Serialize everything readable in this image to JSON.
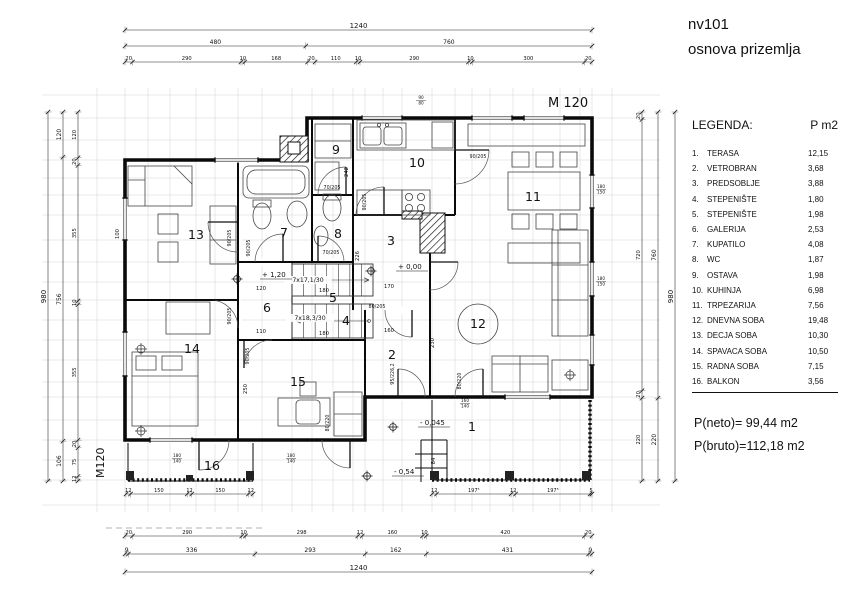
{
  "title": {
    "line1": "nv101",
    "line2": "osnova prizemlja"
  },
  "scale": {
    "main": "M 120",
    "side": "M120"
  },
  "legend": {
    "title": "LEGENDA:",
    "area_header": "P m2",
    "items": [
      {
        "num": "1.",
        "name": "TERASA",
        "area": "12,15"
      },
      {
        "num": "2.",
        "name": "VETROBRAN",
        "area": "3,68"
      },
      {
        "num": "3.",
        "name": "PREDSOBLJE",
        "area": "3,88"
      },
      {
        "num": "4.",
        "name": "STEPENIŠTE",
        "area": "1,80"
      },
      {
        "num": "5.",
        "name": "STEPENIŠTE",
        "area": "1,98"
      },
      {
        "num": "6.",
        "name": "GALERIJA",
        "area": "2,53"
      },
      {
        "num": "7.",
        "name": "KUPATILO",
        "area": "4,08"
      },
      {
        "num": "8.",
        "name": "WC",
        "area": "1,87"
      },
      {
        "num": "9.",
        "name": "OSTAVA",
        "area": "1,98"
      },
      {
        "num": "10.",
        "name": "KUHINJA",
        "area": "6,98"
      },
      {
        "num": "11.",
        "name": "TRPEZARIJA",
        "area": "7,56"
      },
      {
        "num": "12.",
        "name": "DNEVNA SOBA",
        "area": "19,48"
      },
      {
        "num": "13.",
        "name": "DECJA SOBA",
        "area": "10,30"
      },
      {
        "num": "14.",
        "name": "SPAVACA SOBA",
        "area": "10,50"
      },
      {
        "num": "15.",
        "name": "RADNA SOBA",
        "area": "7,15"
      },
      {
        "num": "16.",
        "name": "BALKON",
        "area": "3,56"
      }
    ],
    "neto": "P(neto)= 99,44 m2",
    "bruto": "P(bruto)=112,18 m2"
  },
  "plan": {
    "room_numbers": [
      "1",
      "2",
      "3",
      "4",
      "5",
      "6",
      "7",
      "8",
      "9",
      "10",
      "11",
      "12",
      "13",
      "14",
      "15",
      "16"
    ],
    "stair_labels": [
      "7x17,1/30",
      "7x18,3/30"
    ],
    "level_labels": [
      "+ 1,20",
      "+ 0,00",
      "- 0,045",
      "- 0,54"
    ],
    "door_labels": [
      "90/205",
      "90/205",
      "90/205",
      "90/205",
      "70/205",
      "70/205",
      "90/205",
      "90/205",
      "80/205",
      "95/226,2",
      "80/220",
      "80/220"
    ],
    "inner_dims": [
      "242",
      "226",
      "170",
      "120",
      "110",
      "180",
      "180",
      "160",
      "230",
      "250",
      "100",
      "84"
    ],
    "window_marks": [
      {
        "w": "90",
        "p": "80"
      },
      {
        "w": "180",
        "p": "150"
      },
      {
        "w": "180",
        "p": "150"
      },
      {
        "w": "180",
        "p": "140"
      },
      {
        "w": "180",
        "p": "140"
      },
      {
        "w": "160",
        "p": "140"
      }
    ]
  },
  "dims": {
    "top1": [
      "1240"
    ],
    "top2": [
      "480",
      "760"
    ],
    "top3": [
      "20",
      "290",
      "10",
      "168",
      "20",
      "110",
      "10",
      "290",
      "10",
      "300",
      "20"
    ],
    "bottom1": [
      "20",
      "290",
      "10",
      "298",
      "12",
      "160",
      "10",
      "420",
      "20"
    ],
    "bottom2": [
      "9",
      "336",
      "293",
      "162",
      "431",
      "9"
    ],
    "bottom3": [
      "1240"
    ],
    "left_outer": [
      "980"
    ],
    "left_mid": [
      "120",
      "756",
      "106"
    ],
    "left_inner": [
      "120",
      "20",
      "355",
      "10",
      "355",
      "20",
      "75",
      "12"
    ],
    "right_inner": [
      "20",
      "720",
      "20",
      "220"
    ],
    "right_mid": [
      "760",
      "220"
    ],
    "right_outer": [
      "980"
    ],
    "balcony": [
      "12",
      "150",
      "12",
      "150",
      "12"
    ],
    "terrace": [
      "12",
      "197⁵",
      "12",
      "197⁵",
      "5"
    ]
  }
}
